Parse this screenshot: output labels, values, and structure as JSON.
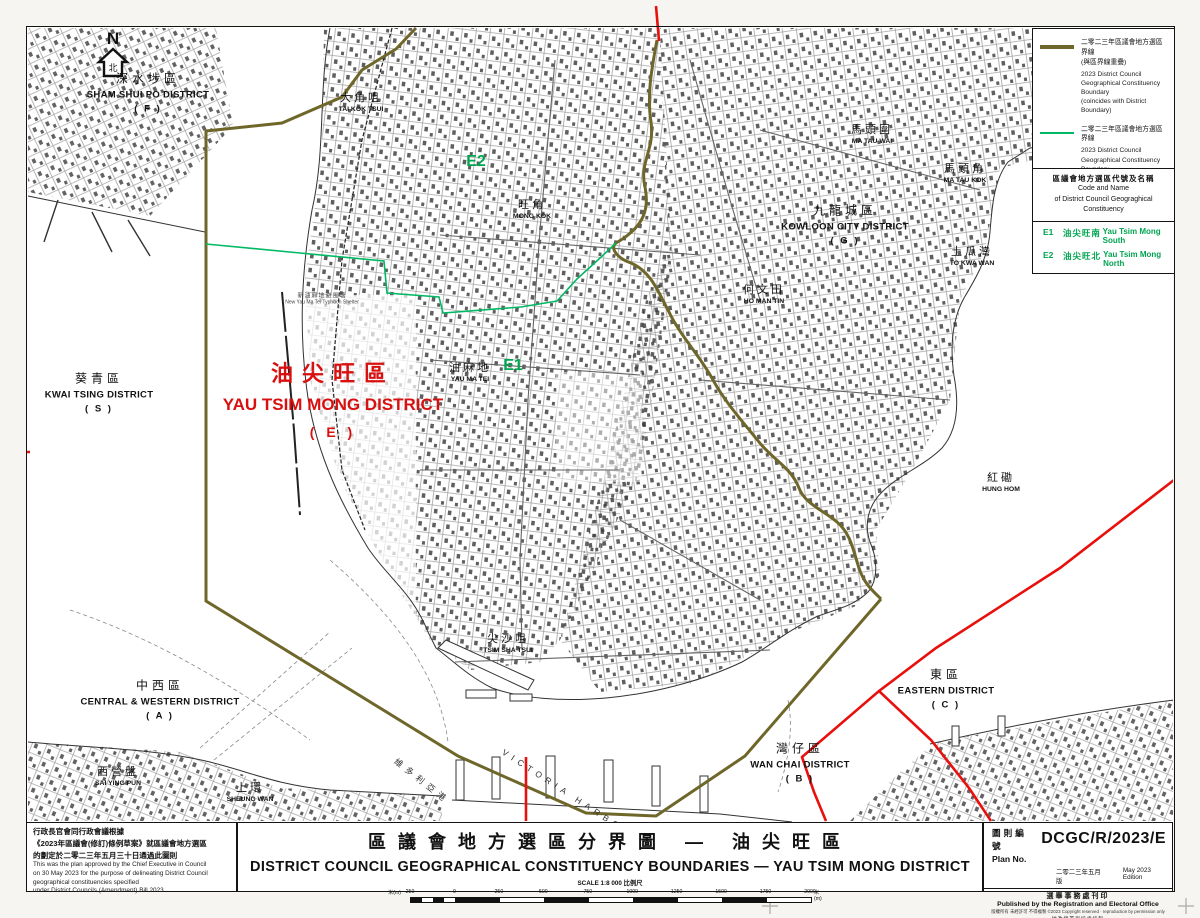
{
  "colors": {
    "boundary_coincide": "#6f662a",
    "boundary_constituency": "#00b964",
    "boundary_district": "#e8100c",
    "district_red_text": "#d8100f",
    "code_green_text": "#00a550"
  },
  "legend": {
    "items": [
      {
        "cn": "二零二三年區議會地方選區界線\n(與區界線重疊)",
        "en": "2023 District Council\nGeographical Constituency\nBoundary\n(coincides with District Boundary)"
      },
      {
        "cn": "二零二三年區議會地方選區界線",
        "en": "2023 District Council\nGeographical Constituency\nBoundary"
      },
      {
        "cn": "區界線",
        "en": "District Boundary"
      }
    ]
  },
  "code_table": {
    "header_cn": "區議會地方選區代號及名稱",
    "header_en1": "Code and Name",
    "header_en2": "of District Council Geograghical Constituency",
    "rows": [
      {
        "code": "E1",
        "cn": "油尖旺南",
        "en": "Yau Tsim Mong South"
      },
      {
        "code": "E2",
        "cn": "油尖旺北",
        "en": "Yau Tsim Mong North"
      }
    ]
  },
  "approval_note": {
    "cn": "行政長官會同行政會議根據\n《2023年區議會(修訂)條例草案》就區議會地方選區\n的劃定於二零二三年五月三十日通過此圖則",
    "en": "This was the plan approved by the Chief Executive in Council\non 30 May 2023 for the purpose of delineating District Council\ngeographical constituencies specified\nunder District Councils (Amendment) Bill 2023"
  },
  "title_block": {
    "cn": "區議會地方選區分界圖 — 油尖旺區",
    "en": "DISTRICT COUNCIL GEOGRAPHICAL CONSTITUENCY BOUNDARIES  —  YAU TSIM MONG DISTRICT",
    "scale_label": "SCALE 1:8 000 比例尺",
    "scale_unit": "米(m)",
    "scale_ticks": [
      "250",
      "0",
      "250",
      "500",
      "750",
      "1000",
      "1250",
      "1500",
      "1750",
      "2000"
    ]
  },
  "plan_block": {
    "label_cn": "圖則編號",
    "label_en": "Plan No.",
    "number": "DCGC/R/2023/E",
    "edition_cn": "二零二三年五月版",
    "edition_en": "May 2023 Edition",
    "publisher_cn": "選舉事務處刊印",
    "publisher_en": "Published by the Registration and Electoral Office",
    "copyright": "版權所有 未經許可 不得複製 ©2023 Copyright reserved · reproduction by permission only",
    "carto_cn": "地政總署測繪處繪製",
    "carto_en": "Cartography by Survey & Mapping Office, Lands Department"
  },
  "north_arrow": {
    "letter": "N",
    "cn": "北"
  },
  "map": {
    "labels": [
      {
        "id": "sham-shui-po-district",
        "type": "district",
        "x": 148,
        "y": 92,
        "lines": [
          "深水埗區",
          "SHAM SHUI PO DISTRICT",
          "( F )"
        ]
      },
      {
        "id": "kwai-tsing-district",
        "type": "district",
        "x": 99,
        "y": 392,
        "lines": [
          "葵青區",
          "KWAI TSING DISTRICT",
          "( S )"
        ]
      },
      {
        "id": "kowloon-city-district",
        "type": "district",
        "x": 845,
        "y": 224,
        "lines": [
          "九龍城區",
          "KOWLOON CITY DISTRICT",
          "( G )"
        ]
      },
      {
        "id": "central-western-district",
        "type": "district",
        "x": 160,
        "y": 699,
        "lines": [
          "中西區",
          "CENTRAL & WESTERN DISTRICT",
          "( A )"
        ]
      },
      {
        "id": "wan-chai-district",
        "type": "district",
        "x": 800,
        "y": 762,
        "lines": [
          "灣仔區",
          "WAN CHAI DISTRICT",
          "( B )"
        ]
      },
      {
        "id": "eastern-district",
        "type": "district",
        "x": 946,
        "y": 688,
        "lines": [
          "東區",
          "EASTERN DISTRICT",
          "( C )"
        ]
      },
      {
        "id": "yau-tsim-mong-district",
        "type": "red",
        "x": 333,
        "y": 398,
        "lines": [
          "油尖旺區",
          "YAU TSIM MONG DISTRICT",
          "( E )"
        ]
      },
      {
        "id": "tai-kok-tsui",
        "type": "place",
        "x": 361,
        "y": 101,
        "lines": [
          "大角咀",
          "TAI KOK TSUI"
        ]
      },
      {
        "id": "mong-kok",
        "type": "place",
        "x": 532,
        "y": 208,
        "lines": [
          "旺角",
          "MONG KOK"
        ]
      },
      {
        "id": "yau-ma-tei",
        "type": "place",
        "x": 470,
        "y": 371,
        "lines": [
          "油麻地",
          "YAU MA TEI"
        ]
      },
      {
        "id": "tsim-sha-tsui",
        "type": "place",
        "x": 508,
        "y": 642,
        "lines": [
          "尖沙咀",
          "TSIM SHA TSUI"
        ]
      },
      {
        "id": "ma-tau-wai",
        "type": "place",
        "x": 872,
        "y": 133,
        "lines": [
          "馬頭圍",
          "MA TAU WAI"
        ]
      },
      {
        "id": "ma-tau-kok",
        "type": "place",
        "x": 965,
        "y": 172,
        "lines": [
          "馬頭角",
          "MA TAU KOK"
        ]
      },
      {
        "id": "to-kwa-wan",
        "type": "place",
        "x": 972,
        "y": 255,
        "lines": [
          "土瓜灣",
          "TO KWA WAN"
        ]
      },
      {
        "id": "ho-man-tin",
        "type": "place",
        "x": 764,
        "y": 293,
        "lines": [
          "何文田",
          "HO MAN TIN"
        ]
      },
      {
        "id": "hung-hom",
        "type": "place",
        "x": 1001,
        "y": 481,
        "lines": [
          "紅磡",
          "HUNG HOM"
        ]
      },
      {
        "id": "sai-ying-pun",
        "type": "place",
        "x": 118,
        "y": 775,
        "lines": [
          "西營盤",
          "SAI YING PUN"
        ]
      },
      {
        "id": "sheung-wan",
        "type": "place",
        "x": 250,
        "y": 791,
        "lines": [
          "上環",
          "SHEUNG WAN"
        ]
      },
      {
        "id": "constituency-code-e2",
        "type": "code",
        "x": 476,
        "y": 162,
        "lines": [
          "E2"
        ]
      },
      {
        "id": "constituency-code-e1",
        "type": "code",
        "x": 513,
        "y": 366,
        "lines": [
          "E1"
        ]
      },
      {
        "id": "victoria-harbour-cn",
        "type": "water",
        "x": 422,
        "y": 781,
        "rot": 38,
        "lines": [
          "維多利亞港"
        ]
      },
      {
        "id": "victoria-harbour-en",
        "type": "water",
        "x": 572,
        "y": 796,
        "rot": 33,
        "lines": [
          "VICTORIA HARBOUR"
        ]
      },
      {
        "id": "typhoon-shelter",
        "type": "tiny",
        "x": 322,
        "y": 298,
        "lines": [
          "新油麻地避風塘",
          "New Yau Ma Tei Typhoon Shelter"
        ]
      }
    ]
  }
}
